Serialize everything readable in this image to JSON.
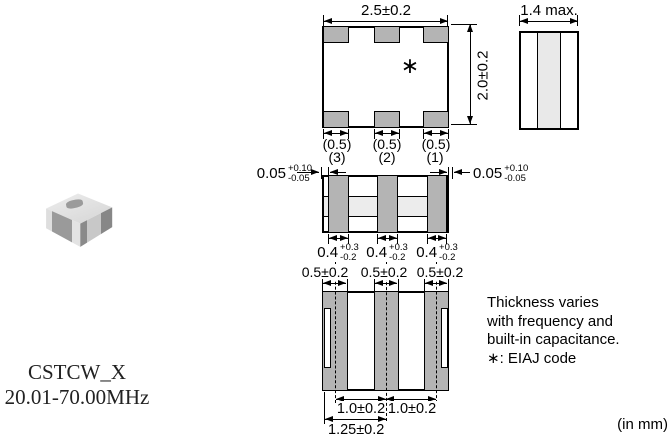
{
  "product": {
    "series": "CSTCW_X",
    "frequency_range": "20.01-70.00MHz"
  },
  "unit_note": "(in mm)",
  "note": {
    "line1": "Thickness varies",
    "line2": "with frequency and",
    "line3": "built-in capacitance.",
    "line4": "∗: EIAJ code"
  },
  "top_view": {
    "width_dim": "2.5±0.2",
    "height_dim": "2.0±0.2",
    "eiaj_mark": "∗",
    "pad_width_dims": [
      "(0.5)",
      "(0.5)",
      "(0.5)"
    ]
  },
  "side_view": {
    "thickness_dim": "1.4 max."
  },
  "front_view": {
    "terminal_numbers": [
      "(3)",
      "(2)",
      "(1)"
    ],
    "left_margin_dim": {
      "value": "0.05",
      "plus": "+0.10",
      "minus": "-0.05"
    },
    "right_margin_dim": {
      "value": "0.05",
      "plus": "+0.10",
      "minus": "-0.05"
    },
    "terminal_width_dims": [
      {
        "value": "0.4",
        "plus": "+0.3",
        "minus": "-0.2"
      },
      {
        "value": "0.4",
        "plus": "+0.3",
        "minus": "-0.2"
      },
      {
        "value": "0.4",
        "plus": "+0.3",
        "minus": "-0.2"
      }
    ]
  },
  "bottom_view": {
    "pad_width_dims": [
      "0.5±0.2",
      "0.5±0.2",
      "0.5±0.2"
    ],
    "pitch_dims": [
      "1.0±0.2",
      "1.0±0.2"
    ],
    "edge_to_center_dim": "1.25±0.2"
  }
}
